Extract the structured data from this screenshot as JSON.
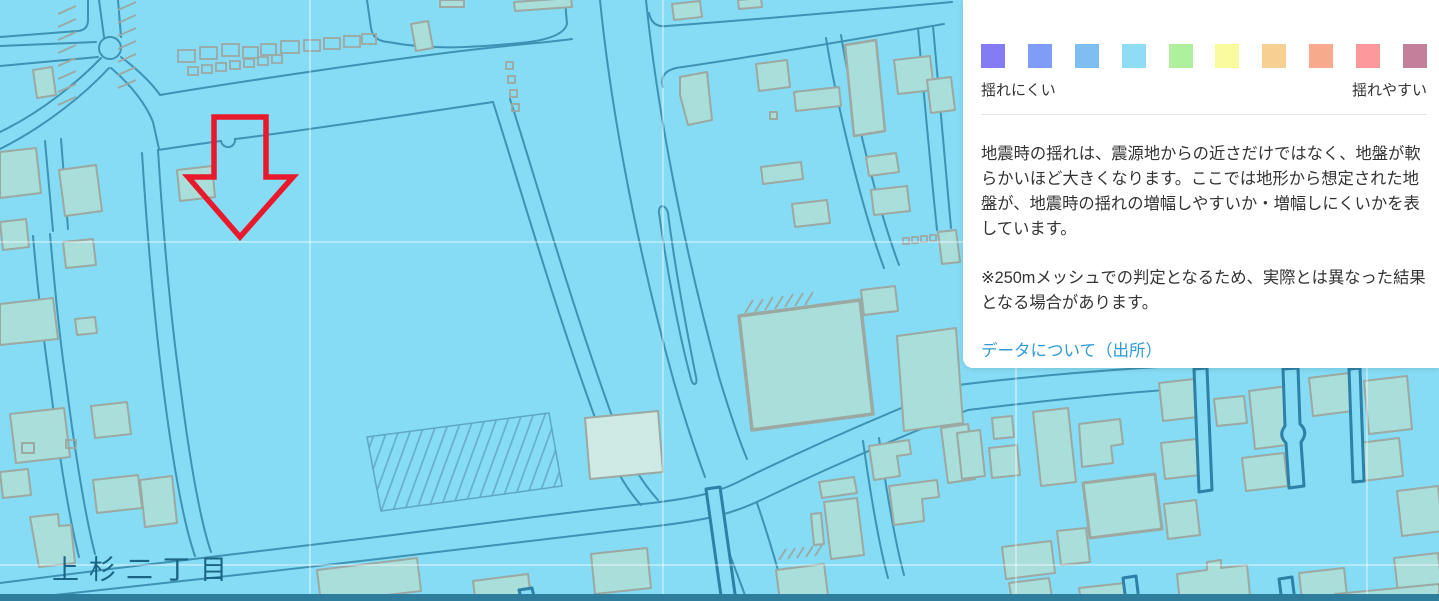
{
  "map": {
    "district_label": "上杉二丁目",
    "background_color": "#86dcf4",
    "road_line_color": "#3e92b4",
    "building_fill": "#a9dedb",
    "building_outline": "#9ca8a2",
    "annotation_arrow_color": "#e8192c",
    "label_color": "#1a6585"
  },
  "panel": {
    "legend": {
      "colors": [
        "#847cf4",
        "#7f9df6",
        "#7fbdf2",
        "#8fddf5",
        "#aff09d",
        "#fafa9e",
        "#f8cf93",
        "#f8aa8d",
        "#fc999c",
        "#c4809b"
      ],
      "label_left": "揺れにくい",
      "label_right": "揺れやすい"
    },
    "description": "地震時の揺れは、震源地からの近さだけではなく、地盤が軟らかいほど大きくなります。ここでは地形から想定された地盤が、地震時の揺れの増幅しやすいか・増幅しにくいかを表しています。",
    "note": "※250mメッシュでの判定となるため、実際とは異なった結果となる場合があります。",
    "link_label": "データについて（出所）"
  }
}
